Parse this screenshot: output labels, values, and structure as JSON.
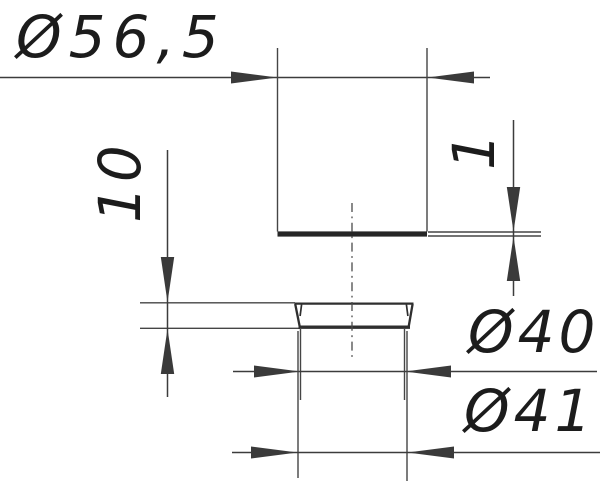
{
  "drawing": {
    "kind": "technical dimension drawing",
    "views": "flanged disc seen edge-on (top view) and tapered ring cross-section (bottom view)",
    "background_color": "#ffffff",
    "line_color": "#3c3c3c",
    "text_color": "#1c1c1c"
  },
  "dimensions": {
    "flange_diameter": {
      "label": "Ø56,5",
      "value": 56.5
    },
    "flange_thickness": {
      "label": "1",
      "value": 1
    },
    "ring_height": {
      "label": "10",
      "value": 10
    },
    "upper_diameter": {
      "label": "Ø40",
      "value": 40
    },
    "lower_diameter": {
      "label": "Ø41",
      "value": 41
    }
  }
}
